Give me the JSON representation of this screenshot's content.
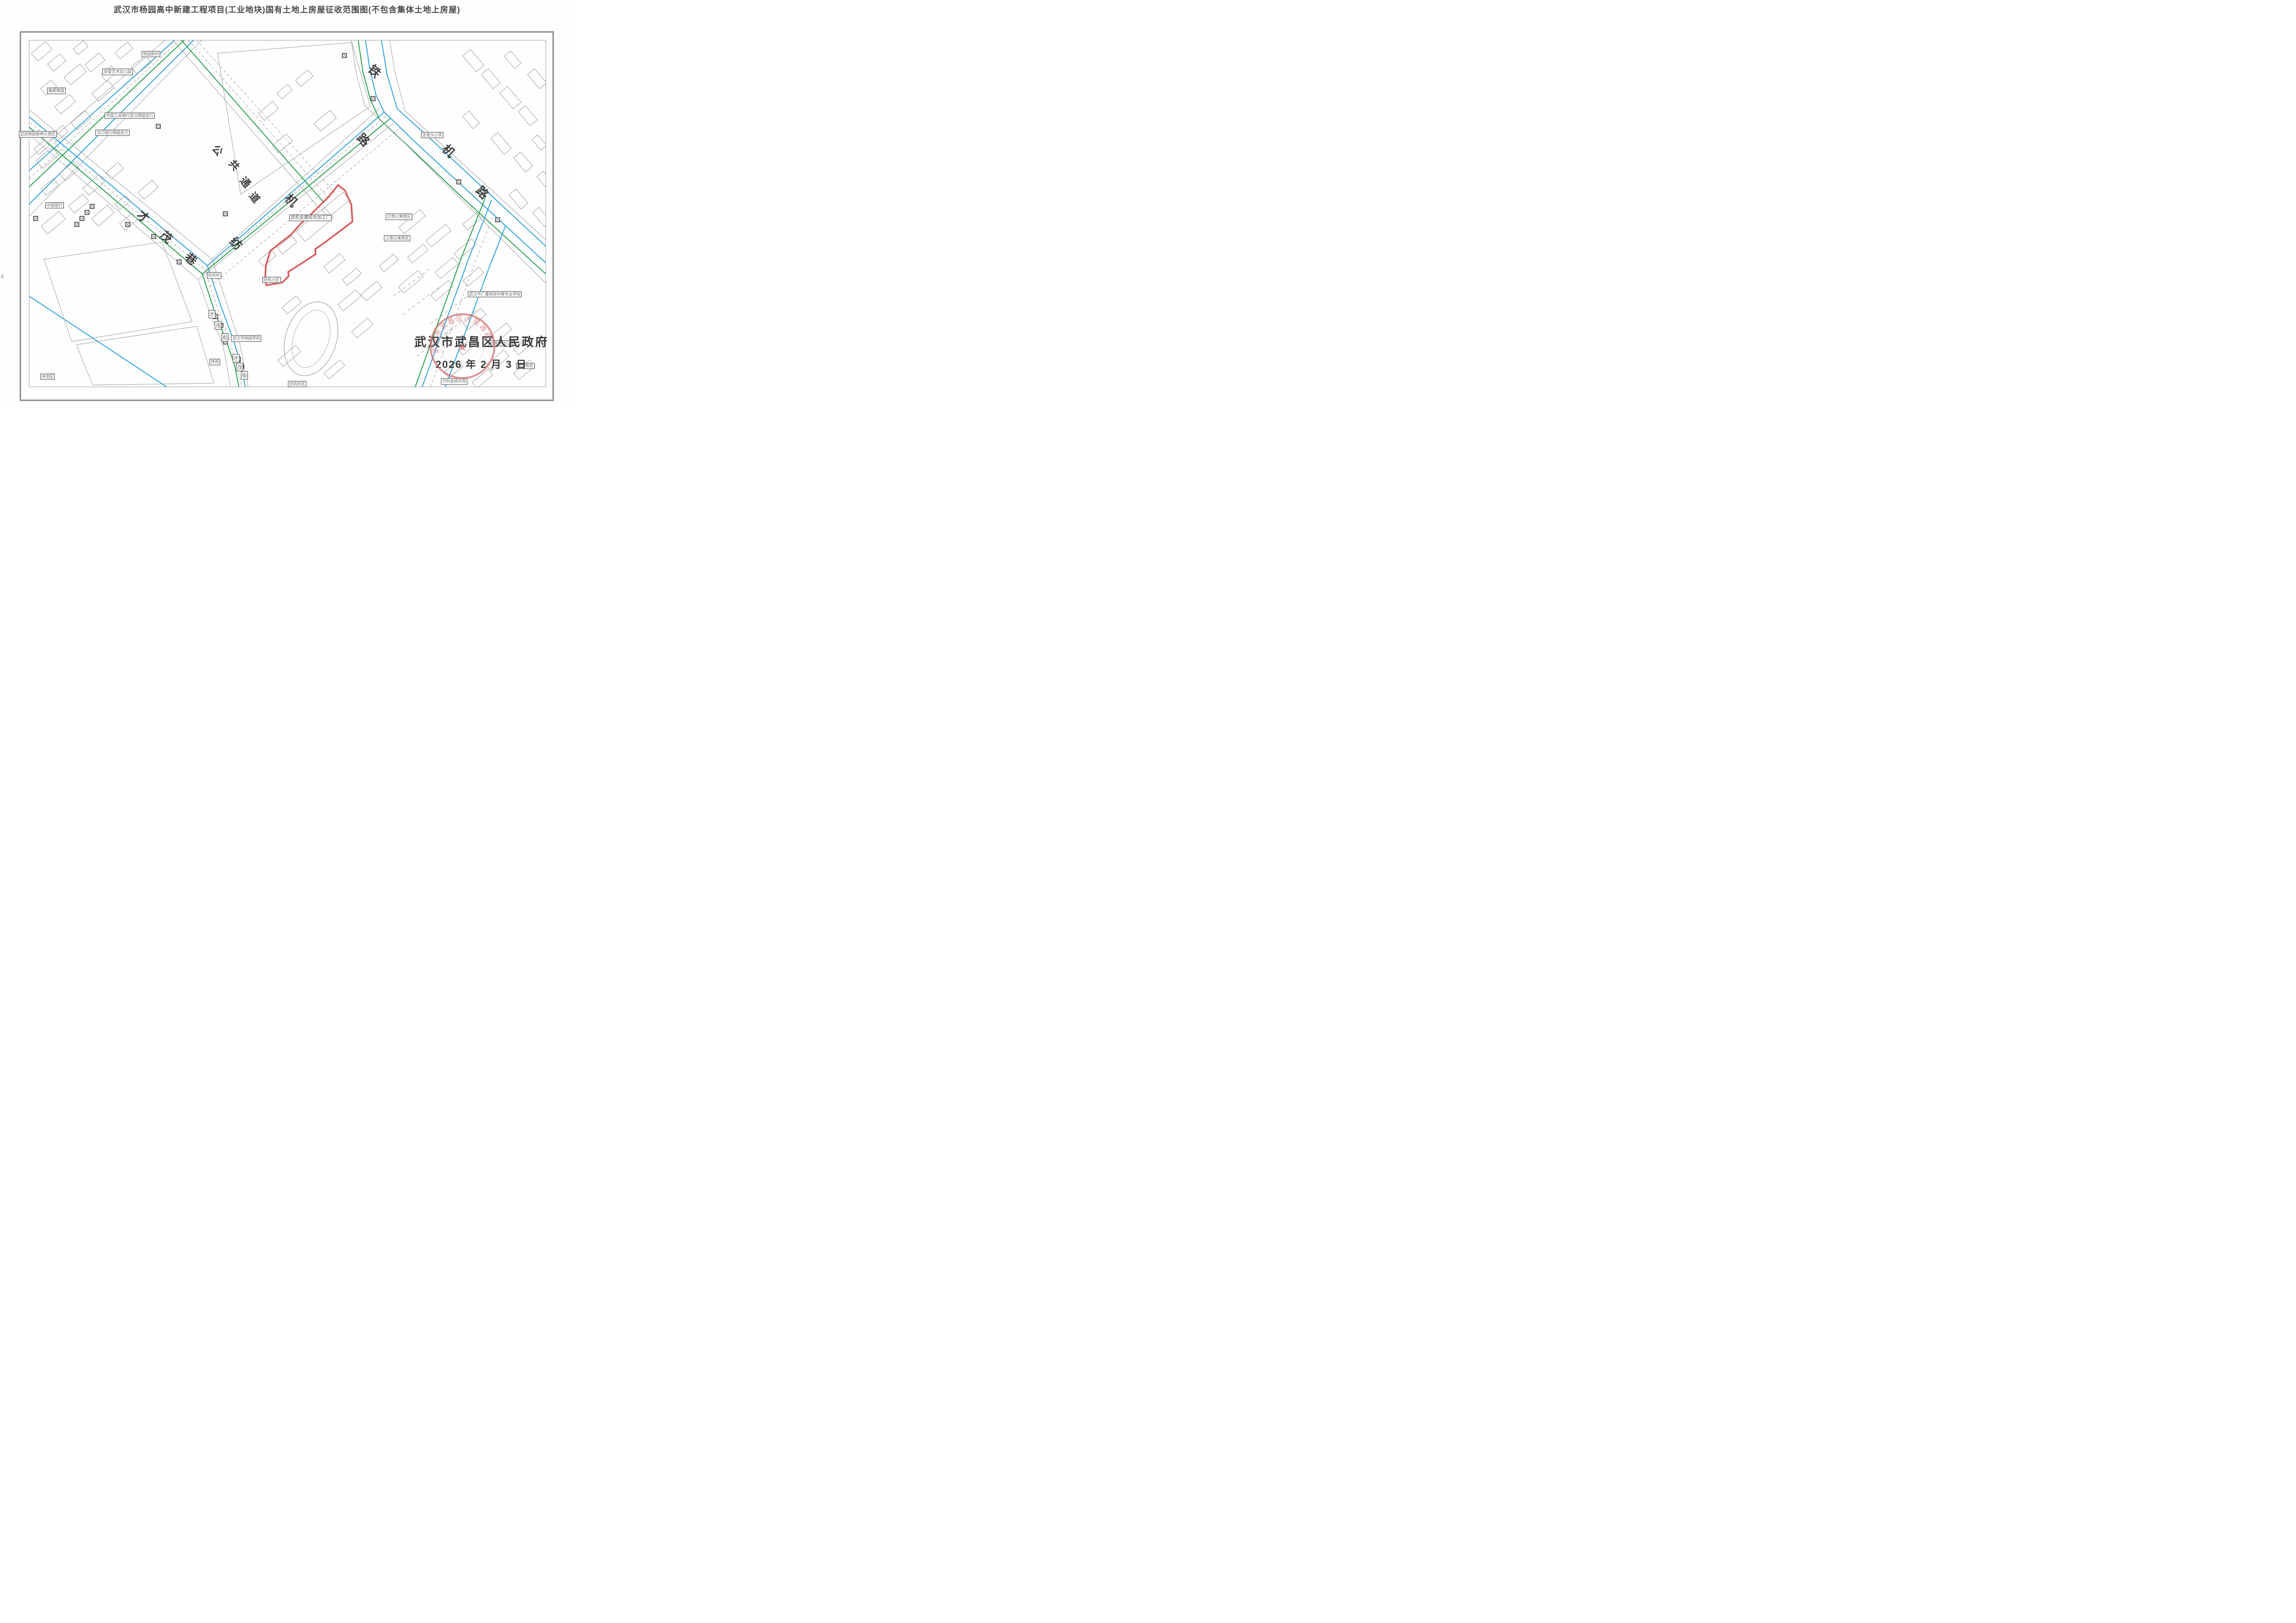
{
  "page": {
    "title": "武汉市杨园高中新建工程项目(工业地块)国有土地上房屋征收范围图(不包含集体土地上房屋)",
    "margin_page_number": "8"
  },
  "authority": {
    "name": "武汉市武昌区人民政府",
    "date": "2026 年 2 月 3 日",
    "seal": {
      "text": "武汉市武昌区人民政府",
      "star": "★",
      "color": "#c96262"
    }
  },
  "colors": {
    "road_blue": "#2fa3dc",
    "road_green": "#27a14e",
    "building_gray": "#9b9b9b",
    "boundary_red": "#d85c5c",
    "frame_gray": "#8a8a8a",
    "label_border": "#3c3c3c",
    "title_text": "#4a4a4a"
  },
  "red_boundary": {
    "label": "武机金属综合加工厂",
    "points_pct": [
      [
        58.9,
        45.6
      ],
      [
        60.1,
        46.9
      ],
      [
        61.2,
        50.4
      ],
      [
        61.4,
        54.6
      ],
      [
        59.0,
        57.2
      ],
      [
        56.7,
        59.6
      ],
      [
        54.9,
        61.4
      ],
      [
        55.0,
        62.6
      ],
      [
        52.2,
        65.2
      ],
      [
        50.2,
        67.0
      ],
      [
        50.3,
        68.0
      ],
      [
        49.2,
        69.6
      ],
      [
        46.4,
        70.3
      ],
      [
        46.2,
        68.7
      ],
      [
        46.3,
        65.6
      ],
      [
        47.1,
        61.8
      ],
      [
        48.8,
        59.9
      ],
      [
        50.7,
        57.8
      ],
      [
        52.4,
        55.1
      ],
      [
        54.4,
        52.5
      ],
      [
        57.3,
        48.4
      ]
    ]
  },
  "place_labels": [
    {
      "text": "杨园新村",
      "x": 26.3,
      "y": 13.3
    },
    {
      "text": "圣婴艺术幼儿园",
      "x": 20.5,
      "y": 17.7
    },
    {
      "text": "馨都雅园",
      "x": 9.8,
      "y": 22.4
    },
    {
      "text": "中国工商银行武汉杨园支行",
      "x": 22.6,
      "y": 28.5
    },
    {
      "text": "汉口银行杨园支行",
      "x": 19.6,
      "y": 32.7
    },
    {
      "text": "武昌杨园柴林头西区",
      "x": 6.6,
      "y": 33.1
    },
    {
      "text": "中国银行",
      "x": 9.5,
      "y": 50.6
    },
    {
      "text": "余家头小学",
      "x": 75.3,
      "y": 33.3
    },
    {
      "text": "江南公寓南区",
      "x": 69.5,
      "y": 53.4
    },
    {
      "text": "江南公寓南区",
      "x": 69.2,
      "y": 58.7
    },
    {
      "text": "武汉市广播电视中等专业学校",
      "x": 86.2,
      "y": 72.5
    },
    {
      "text": "白桦林幼儿园",
      "x": 87.4,
      "y": 84.6
    },
    {
      "text": "万科金城华府",
      "x": 79.1,
      "y": 94.0
    },
    {
      "text": "申宝驾校",
      "x": 91.5,
      "y": 90.2
    },
    {
      "text": "纺机村",
      "x": 37.3,
      "y": 67.9
    },
    {
      "text": "纺机小区",
      "x": 47.3,
      "y": 69.0
    },
    {
      "text": "武汉市杨园学校",
      "x": 42.9,
      "y": 83.4
    },
    {
      "text": "待测区",
      "x": 8.3,
      "y": 92.8
    },
    {
      "text": "待测",
      "x": 37.4,
      "y": 89.2
    },
    {
      "text": "纺机社区",
      "x": 51.8,
      "y": 94.6
    }
  ],
  "site_label": {
    "text": "武机金属综合加工厂",
    "x": 54.1,
    "y": 53.7
  },
  "road_names": [
    {
      "name": "铁机路",
      "chars": [
        {
          "c": "铁",
          "x": 65.3,
          "y": 17.4,
          "r": 45,
          "s": 26
        },
        {
          "c": "机",
          "x": 78.2,
          "y": 37.1,
          "r": 45,
          "s": 26
        },
        {
          "c": "路",
          "x": 84.1,
          "y": 47.3,
          "r": 45,
          "s": 26
        }
      ]
    },
    {
      "name": "纺机路",
      "chars": [
        {
          "c": "纺",
          "x": 41.2,
          "y": 59.9,
          "r": 45,
          "s": 26
        },
        {
          "c": "机",
          "x": 50.8,
          "y": 49.3,
          "r": 45,
          "s": 26
        },
        {
          "c": "路",
          "x": 63.4,
          "y": 34.3,
          "r": 45,
          "s": 26
        }
      ]
    },
    {
      "name": "公共通道",
      "chars": [
        {
          "c": "公",
          "x": 38.0,
          "y": 36.9,
          "r": 50,
          "s": 22
        },
        {
          "c": "共",
          "x": 40.9,
          "y": 40.6,
          "r": 50,
          "s": 22
        },
        {
          "c": "通",
          "x": 42.8,
          "y": 44.8,
          "r": 50,
          "s": 22
        },
        {
          "c": "道",
          "x": 44.4,
          "y": 48.6,
          "r": 50,
          "s": 22
        }
      ]
    },
    {
      "name": "才茂巷",
      "chars": [
        {
          "c": "才",
          "x": 25.0,
          "y": 53.2,
          "r": 40,
          "s": 25
        },
        {
          "c": "茂",
          "x": 29.0,
          "y": 58.3,
          "r": 40,
          "s": 25
        },
        {
          "c": "巷",
          "x": 33.3,
          "y": 63.7,
          "r": 40,
          "s": 25
        }
      ]
    },
    {
      "name": "才茂街",
      "chars": [
        {
          "c": "才",
          "x": 36.9,
          "y": 77.4,
          "r": 0,
          "s": 11,
          "boxed": true
        },
        {
          "c": "茂",
          "x": 38.0,
          "y": 80.2,
          "r": 0,
          "s": 11,
          "boxed": true
        },
        {
          "c": "街",
          "x": 39.2,
          "y": 83.1,
          "r": 0,
          "s": 11,
          "boxed": true
        }
      ]
    },
    {
      "name": "才茂街",
      "chars": [
        {
          "c": "才",
          "x": 41.1,
          "y": 88.2,
          "r": 0,
          "s": 11,
          "boxed": true
        },
        {
          "c": "茂",
          "x": 41.8,
          "y": 90.4,
          "r": 0,
          "s": 11,
          "boxed": true
        },
        {
          "c": "街",
          "x": 42.6,
          "y": 92.5,
          "r": 0,
          "s": 11,
          "boxed": true
        }
      ]
    }
  ]
}
